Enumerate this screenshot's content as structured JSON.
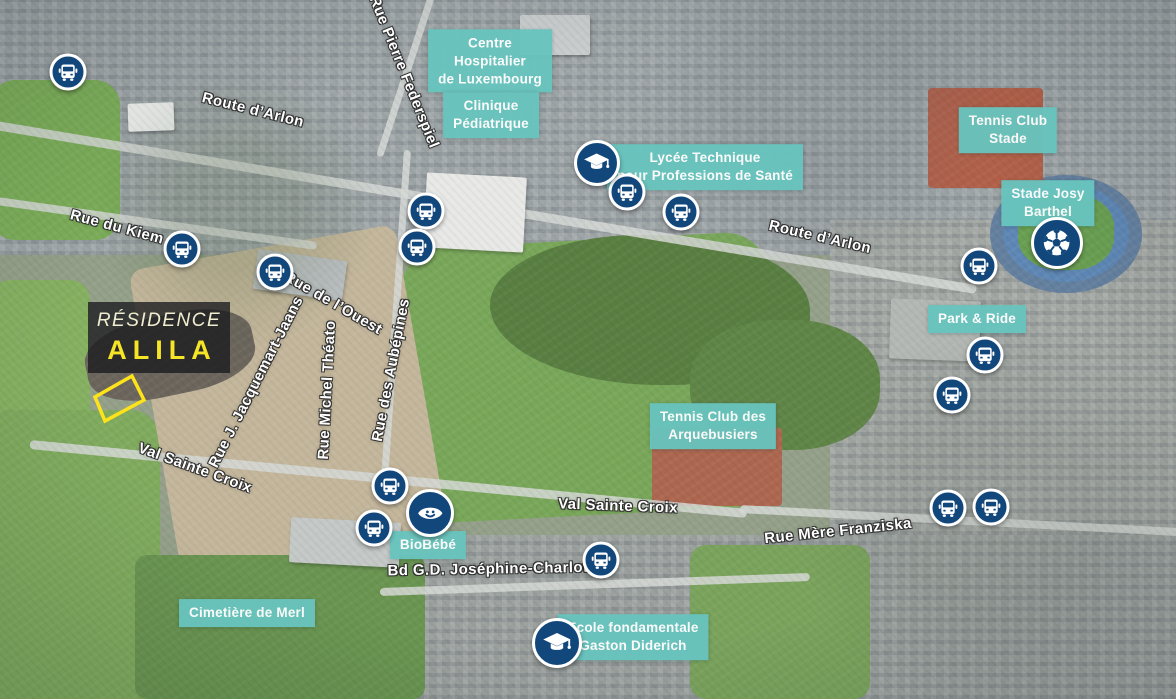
{
  "residence": {
    "line1": "RÉSIDENCE",
    "line2": "ALILA"
  },
  "poi_labels": [
    {
      "id": "centre-hospitalier",
      "text": "Centre\nHospitalier\nde Luxembourg",
      "x": 490,
      "y": 61
    },
    {
      "id": "clinique-pediatrique",
      "text": "Clinique\nPédiatrique",
      "x": 491,
      "y": 115
    },
    {
      "id": "lycee-technique-sante",
      "text": "Lycée Technique\npour Professions de Santé",
      "x": 705,
      "y": 167
    },
    {
      "id": "tennis-club-stade",
      "text": "Tennis Club\nStade",
      "x": 1008,
      "y": 130
    },
    {
      "id": "stade-josy-barthel",
      "text": "Stade Josy\nBarthel",
      "x": 1048,
      "y": 203
    },
    {
      "id": "park-and-ride",
      "text": "Park & Ride",
      "x": 977,
      "y": 319
    },
    {
      "id": "tennis-club-arquebusiers",
      "text": "Tennis Club des\nArquebusiers",
      "x": 713,
      "y": 426
    },
    {
      "id": "biobebe",
      "text": "BioBébé",
      "x": 428,
      "y": 545
    },
    {
      "id": "cimetiere-de-merl",
      "text": "Cimetière de Merl",
      "x": 247,
      "y": 613
    },
    {
      "id": "ecole-gaston-diderich",
      "text": "Ecole fondamentale\nGaston Diderich",
      "x": 633,
      "y": 637
    }
  ],
  "street_labels": [
    {
      "text": "Route d’Arlon",
      "x": 253,
      "y": 110,
      "angle": 14
    },
    {
      "text": "Rue Pierre Federspiel",
      "x": 404,
      "y": 72,
      "angle": 68
    },
    {
      "text": "Rue du Kiem",
      "x": 117,
      "y": 227,
      "angle": 15
    },
    {
      "text": "Rue de l’Ouest",
      "x": 333,
      "y": 303,
      "angle": 30
    },
    {
      "text": "Rue J. Jacquemart-Jaans",
      "x": 256,
      "y": 382,
      "angle": -63
    },
    {
      "text": "Rue Michel Théato",
      "x": 327,
      "y": 390,
      "angle": -87
    },
    {
      "text": "Rue des Aubépines",
      "x": 391,
      "y": 370,
      "angle": -79
    },
    {
      "text": "Route d’Arlon",
      "x": 820,
      "y": 237,
      "angle": 13
    },
    {
      "text": "Val Sainte Croix",
      "x": 195,
      "y": 468,
      "angle": 20
    },
    {
      "text": "Val Sainte Croix",
      "x": 618,
      "y": 506,
      "angle": 2
    },
    {
      "text": "Rue Mère Franziska",
      "x": 838,
      "y": 531,
      "angle": -6
    },
    {
      "text": "Bd G.D. Joséphine-Charlotte",
      "x": 495,
      "y": 569,
      "angle": -1
    }
  ],
  "transit_stops": [
    {
      "x": 68,
      "y": 72
    },
    {
      "x": 182,
      "y": 249
    },
    {
      "x": 275,
      "y": 272
    },
    {
      "x": 426,
      "y": 211
    },
    {
      "x": 417,
      "y": 247
    },
    {
      "x": 627,
      "y": 192
    },
    {
      "x": 681,
      "y": 212
    },
    {
      "x": 979,
      "y": 266
    },
    {
      "x": 985,
      "y": 355
    },
    {
      "x": 952,
      "y": 395
    },
    {
      "x": 948,
      "y": 508
    },
    {
      "x": 991,
      "y": 507
    },
    {
      "x": 390,
      "y": 486
    },
    {
      "x": 374,
      "y": 528
    },
    {
      "x": 601,
      "y": 560
    }
  ],
  "special_markers": [
    {
      "icon": "graduation-cap-icon",
      "x": 597,
      "y": 163,
      "size": 46
    },
    {
      "icon": "graduation-cap-icon",
      "x": 557,
      "y": 643,
      "size": 50
    },
    {
      "icon": "soccer-ball-icon",
      "x": 1057,
      "y": 243,
      "size": 52
    },
    {
      "icon": "smiley-face-icon",
      "x": 430,
      "y": 513,
      "size": 48
    }
  ],
  "site_outline": {
    "points": "95,397 132,376 144,400 105,421"
  },
  "colors": {
    "poi_label_bg": "#68c4be",
    "poi_label_text": "#ffffff",
    "marker_bg": "#12477c",
    "marker_ring": "#ffffff",
    "street_text": "#ffffff",
    "residence_title": "#f0eecf",
    "residence_name": "#f6e426",
    "site_outline": "#ffe31a"
  }
}
